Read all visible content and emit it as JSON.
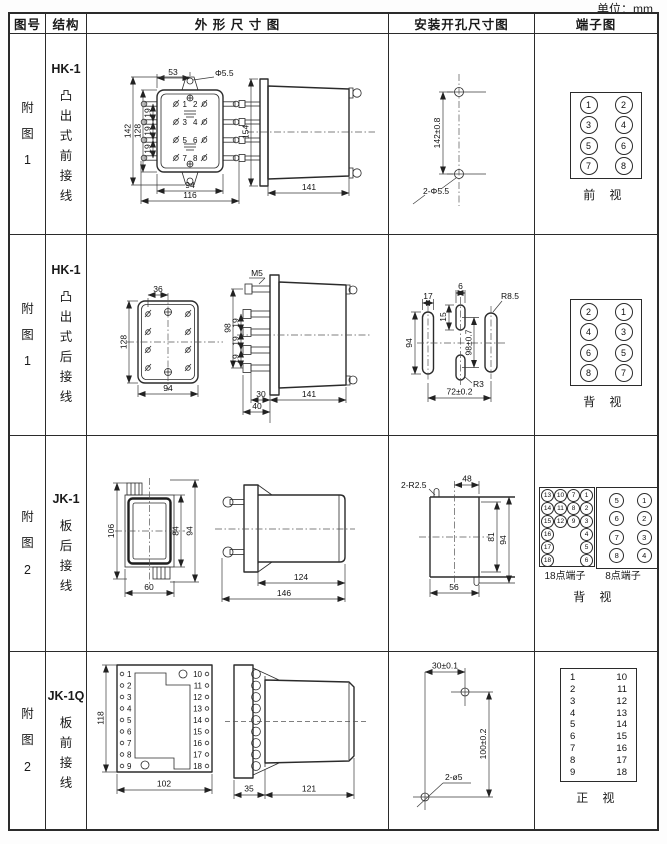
{
  "unit_label": "单位：mm",
  "colors": {
    "line": "#2b2b2b",
    "text": "#141414",
    "background": "#ffffff"
  },
  "header": {
    "fig": "图号",
    "struct": "结构",
    "outline": "外 形 尺 寸 图",
    "mount": "安装开孔尺寸图",
    "terminal": "端子图"
  },
  "row1": {
    "fig": "附\n图\n1",
    "model": "HK-1",
    "desc": "凸\n出\n式\n前\n接\n线",
    "outline": {
      "d53": "53",
      "dphi": "Φ5.5",
      "d142": "142",
      "d128": "128",
      "d19a": "19",
      "d19b": "19",
      "d19c": "19",
      "d94": "94",
      "d116": "116",
      "d154": "154",
      "d141": "141",
      "pins": [
        "1",
        "2",
        "3",
        "4",
        "5",
        "6",
        "7",
        "8"
      ]
    },
    "mount": {
      "d142": "142±0.8",
      "dphi": "2-Φ5.5"
    },
    "terminal": {
      "cells": [
        "1",
        "2",
        "3",
        "4",
        "5",
        "6",
        "7",
        "8"
      ],
      "caption": "前 视"
    }
  },
  "row2": {
    "fig": "附\n图\n1",
    "model": "HK-1",
    "desc": "凸\n出\n式\n后\n接\n线",
    "outline": {
      "d36": "36",
      "d128": "128",
      "d94": "94",
      "m5": "M5",
      "d98": "98",
      "d19a": "19",
      "d19b": "19",
      "d19c": "19",
      "d30": "30",
      "d40": "40",
      "d141": "141"
    },
    "mount": {
      "d17": "17",
      "d94": "94",
      "d6": "6",
      "d15": "15",
      "d98": "98±0.7",
      "r85": "R8.5",
      "r3": "R3",
      "d72": "72±0.2"
    },
    "terminal": {
      "cells": [
        "2",
        "1",
        "4",
        "3",
        "6",
        "5",
        "8",
        "7"
      ],
      "caption": "背 视"
    }
  },
  "row3": {
    "fig": "附\n图\n2",
    "model": "JK-1",
    "desc": "板\n后\n接\n线",
    "outline": {
      "d106": "106",
      "d84": "84",
      "d94": "94",
      "d60": "60",
      "d124": "124",
      "d146": "146"
    },
    "mount": {
      "r25": "2-R2.5",
      "d48": "48",
      "d81": "81",
      "d94": "94",
      "d56": "56"
    },
    "terminal": {
      "grid18": [
        [
          "13",
          "10",
          "7",
          "1"
        ],
        [
          "14",
          "11",
          "8",
          "2"
        ],
        [
          "15",
          "12",
          "9",
          "3"
        ],
        [
          "16",
          "",
          "",
          "4"
        ],
        [
          "17",
          "",
          "",
          "5"
        ],
        [
          "18",
          "",
          "",
          "6"
        ]
      ],
      "grid8": [
        [
          "5",
          "1"
        ],
        [
          "6",
          "2"
        ],
        [
          "7",
          "3"
        ],
        [
          "8",
          "4"
        ]
      ],
      "cap18": "18点端子",
      "cap8": "8点端子",
      "caption": "背 视"
    }
  },
  "row4": {
    "fig": "附\n图\n2",
    "model": "JK-1Q",
    "desc": "板\n前\n接\n线",
    "outline": {
      "d118": "118",
      "d102": "102",
      "d35": "35",
      "d121": "121",
      "left_pins": [
        "1",
        "2",
        "3",
        "4",
        "5",
        "6",
        "7",
        "8",
        "9"
      ],
      "right_pins": [
        "10",
        "11",
        "12",
        "13",
        "14",
        "15",
        "16",
        "17",
        "18"
      ]
    },
    "mount": {
      "d30": "30±0.1",
      "d100": "100±0.2",
      "dphi": "2-ø5"
    },
    "terminal": {
      "left": [
        "1",
        "2",
        "3",
        "4",
        "5",
        "6",
        "7",
        "8",
        "9"
      ],
      "right": [
        "10",
        "11",
        "12",
        "13",
        "14",
        "15",
        "16",
        "17",
        "18"
      ],
      "caption": "正 视"
    }
  }
}
